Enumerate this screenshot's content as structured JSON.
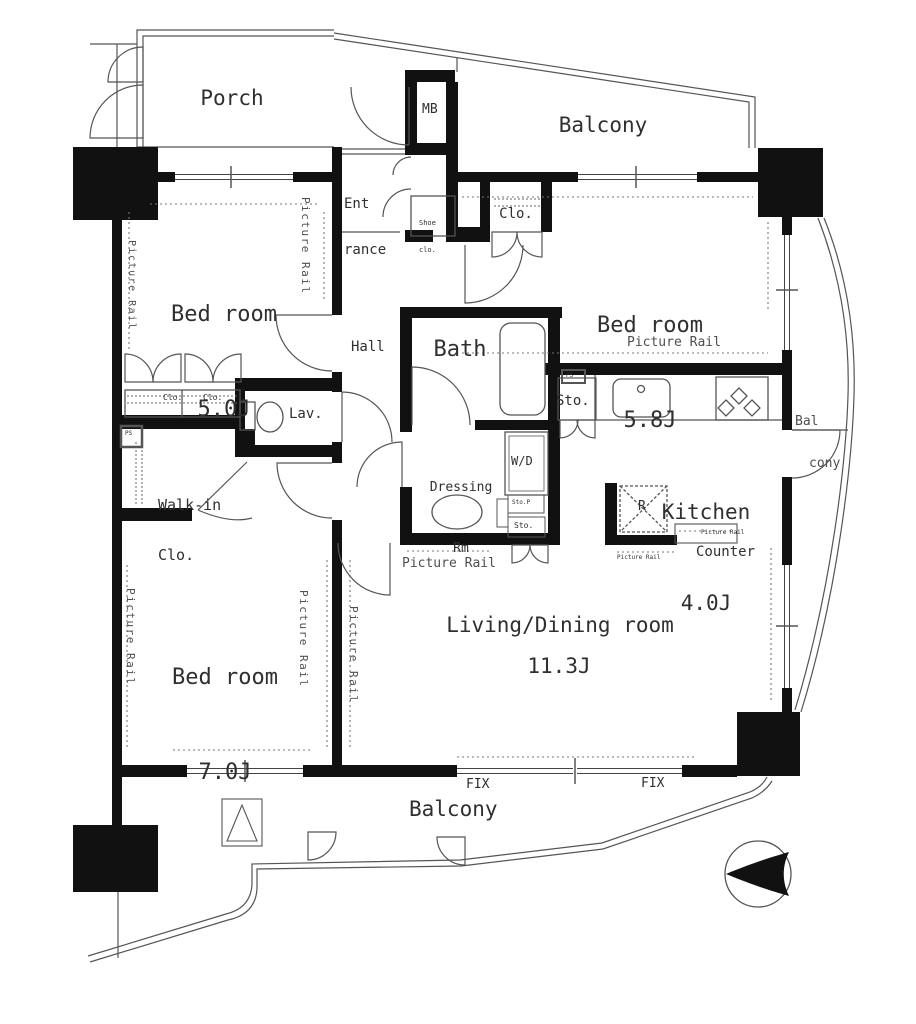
{
  "colors": {
    "wall": "#111111",
    "thin_line": "#555555",
    "dashed_line": "#777777",
    "text": "#2f2f2f"
  },
  "rooms": [
    {
      "name": "Porch"
    },
    {
      "name": "Balcony"
    },
    {
      "name": "Bed room",
      "area": "5.0J"
    },
    {
      "name": "Bed room",
      "area": "5.8J"
    },
    {
      "name": "Bed room",
      "area": "7.0J"
    },
    {
      "name": "Living/Dining room",
      "area": "11.3J"
    },
    {
      "name": "Kitchen",
      "area": "4.0J"
    },
    {
      "name": "Bath"
    },
    {
      "name": "Hall"
    },
    {
      "name": "Lav."
    },
    {
      "name": "Balcony"
    }
  ],
  "labels": {
    "mb": "MB",
    "ent_line1": "Ent",
    "ent_line2": "rance",
    "shoe_line1": "Shoe",
    "shoe_line2": "clo.",
    "clo": "Clo.",
    "walkin_line1": "Walk-in",
    "walkin_line2": "Clo.",
    "dressing_line1": "Dressing",
    "dressing_line2": "Rm",
    "wd": "W/D",
    "sto": "Sto.",
    "sto_p": "Sto.P",
    "ps": "PS",
    "refrigerator": "R",
    "counter": "Counter",
    "fix": "FIX",
    "picture_rail": "Picture Rail",
    "bal_line1": "Bal",
    "bal_line2": "cony"
  }
}
